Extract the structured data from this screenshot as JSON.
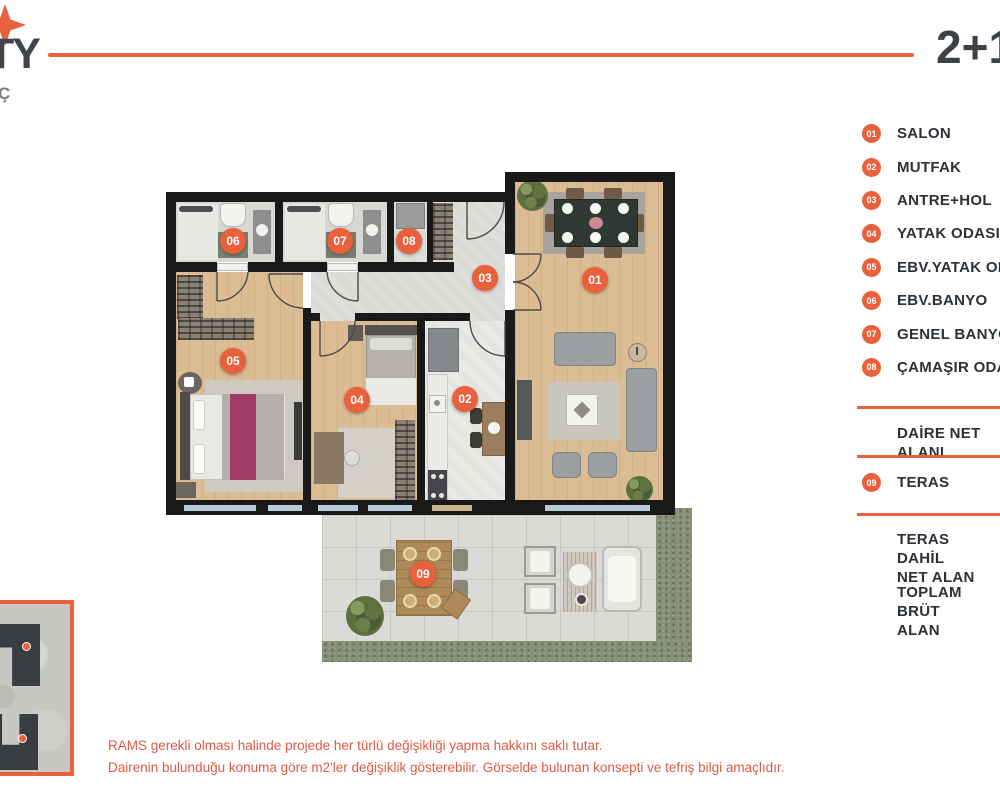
{
  "header": {
    "logo_text": "TY",
    "logo_sub": "Ç",
    "unit_type": "2+1"
  },
  "legend": {
    "items": [
      {
        "num": "01",
        "label": "SALON"
      },
      {
        "num": "02",
        "label": "MUTFAK"
      },
      {
        "num": "03",
        "label": "ANTRE+HOL"
      },
      {
        "num": "04",
        "label": "YATAK ODASI"
      },
      {
        "num": "05",
        "label": "EBV.YATAK ODASI"
      },
      {
        "num": "06",
        "label": "EBV.BANYO"
      },
      {
        "num": "07",
        "label": "GENEL BANYO"
      },
      {
        "num": "08",
        "label": "ÇAMAŞIR ODASI"
      }
    ],
    "net_area_label": "DAİRE NET ALANI",
    "teras": {
      "num": "09",
      "label": "TERAS"
    },
    "teras_net_label": "TERAS DAHİL\nNET ALAN",
    "gross_label": "TOPLAM BRÜT\nALAN"
  },
  "footer": {
    "line1": "RAMS gerekli olması halinde projede her türlü değişikliği yapma hakkını saklı tutar.",
    "line2": "Dairenin bulunduğu konuma göre m2'ler değişiklik gösterebilir. Görselde bulunan konsepti ve tefriş bilgi amaçlıdır."
  },
  "colors": {
    "accent": "#E8603C",
    "text_dark": "#3D4248",
    "disclaimer": "#E15A44"
  }
}
